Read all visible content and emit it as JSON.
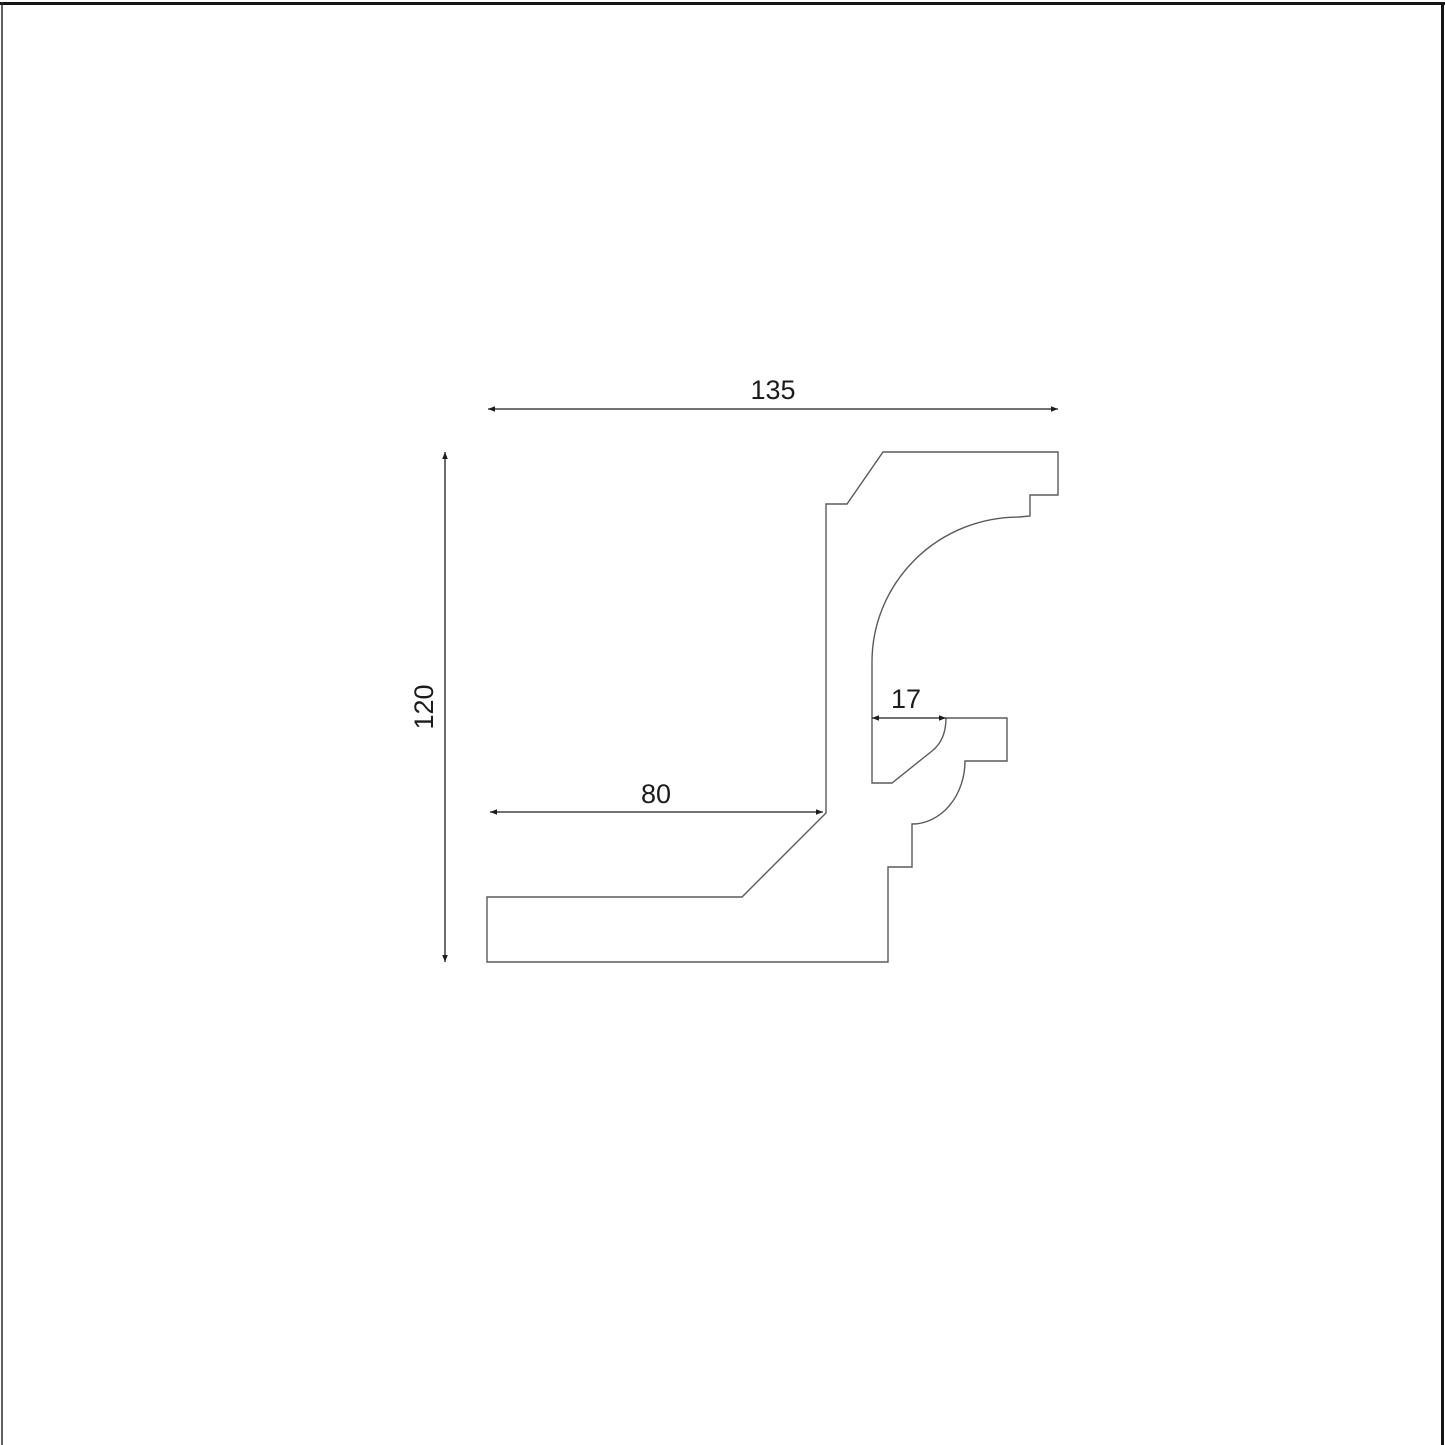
{
  "canvas": {
    "background": "#ffffff",
    "border_color": "#141414",
    "left_border_color": "#2b2b2b",
    "profile_line_color": "#5a5a5a",
    "dimension_color": "#1c1c1c"
  },
  "drawing": {
    "type": "molding-profile-cross-section",
    "profile_path": "M 883 452 L 1058 452 L 1058 495 L 1030 495 L 1030 516 L 1019 517 A 147 145 0 0 0 872 662 L 872 783 L 892 783 L 932 751 Q 946 740 946 718 L 1007 718 L 1007 761 L 965 761 A 53 63 0 0 1 912 824 L 912 867 L 888 867 L 888 962 L 487 962 L 487 897 L 742 897 L 826 813 L 826 504 L 847 504 Z"
  },
  "chart_data": {
    "type": "table",
    "title": "",
    "dimensions": [
      {
        "label": "135",
        "value": 135,
        "orientation": "horizontal",
        "measures": "overall width"
      },
      {
        "label": "120",
        "value": 120,
        "orientation": "vertical",
        "measures": "overall height"
      },
      {
        "label": "80",
        "value": 80,
        "orientation": "horizontal",
        "measures": "bottom flange width"
      },
      {
        "label": "17",
        "value": 17,
        "orientation": "horizontal",
        "measures": "inner ledge offset"
      }
    ]
  },
  "dim135": {
    "label": "135",
    "line": {
      "x1": 488,
      "y1": 409,
      "x2": 1058,
      "y2": 409
    },
    "text": {
      "x": 773,
      "y": 399
    }
  },
  "dim120": {
    "label": "120",
    "line": {
      "x1": 445,
      "y1": 452,
      "x2": 445,
      "y2": 962
    },
    "text": {
      "x": 433,
      "y": 707
    }
  },
  "dim80": {
    "label": "80",
    "line": {
      "x1": 490,
      "y1": 812,
      "x2": 823,
      "y2": 812
    },
    "text": {
      "x": 656,
      "y": 803
    }
  },
  "dim17": {
    "label": "17",
    "line": {
      "x1": 872,
      "y1": 718,
      "x2": 946,
      "y2": 718
    },
    "text": {
      "x": 906,
      "y": 708
    }
  }
}
